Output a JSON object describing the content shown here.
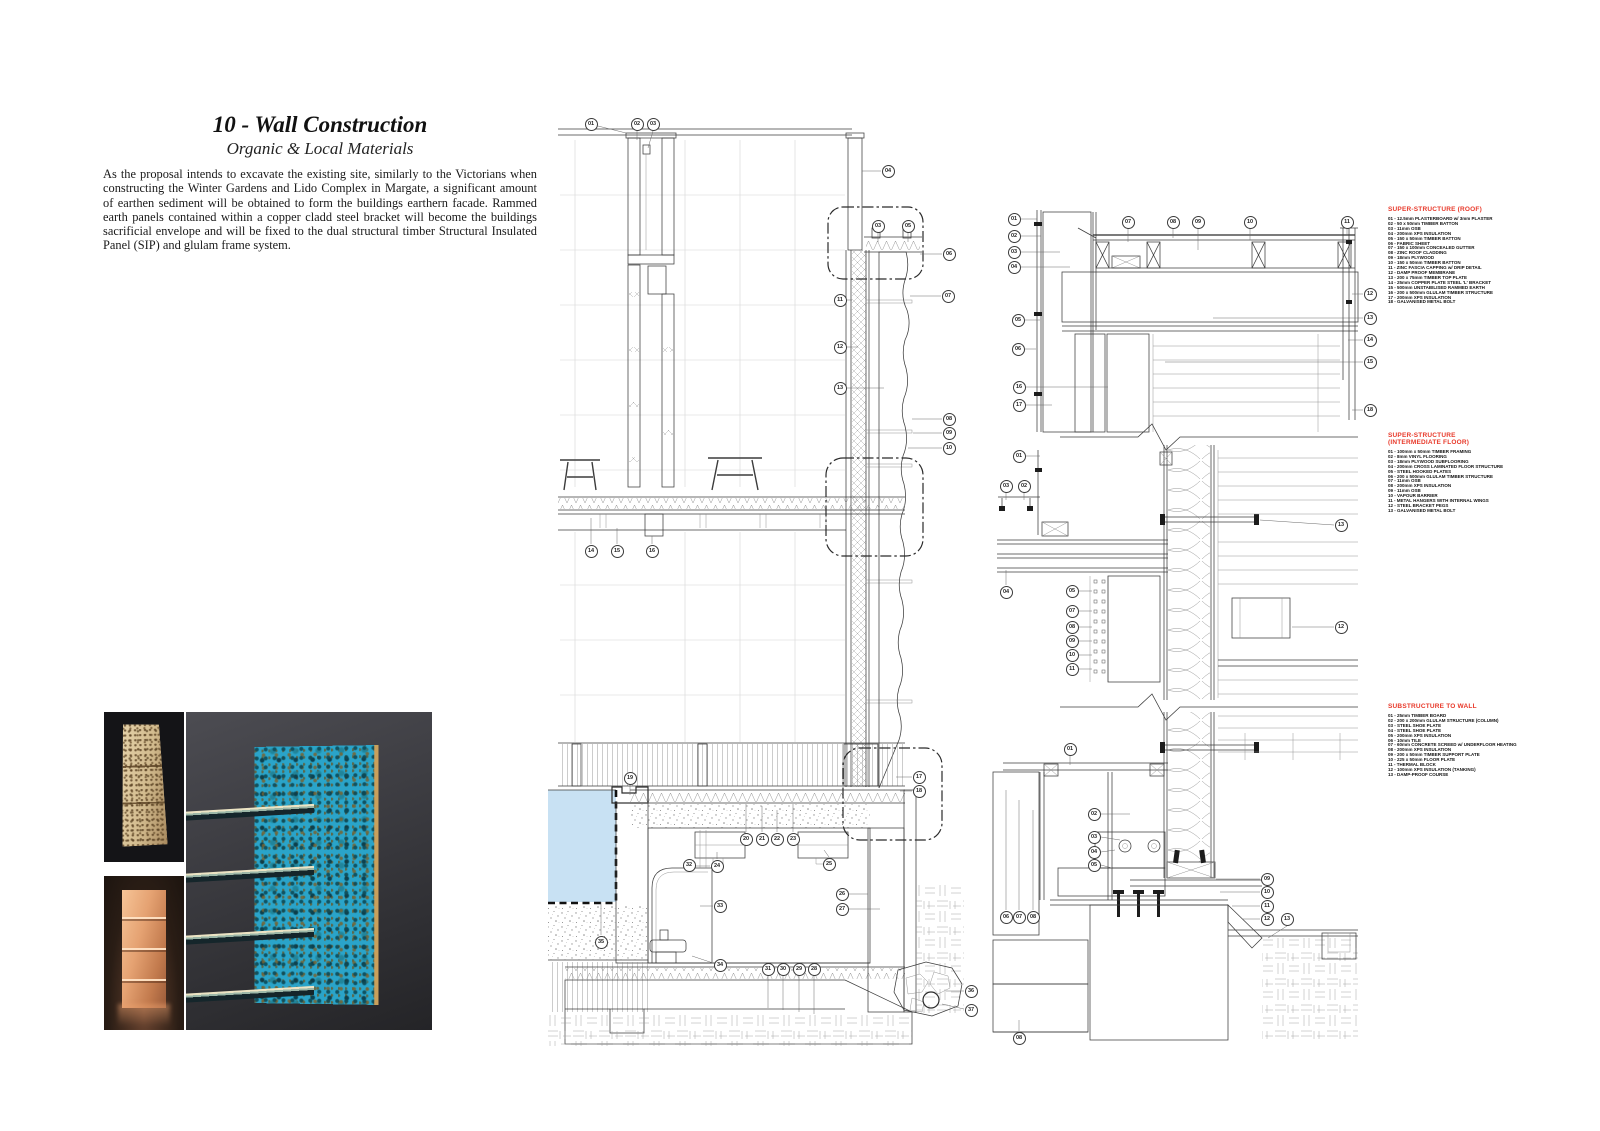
{
  "header": {
    "title": "10 - Wall Construction",
    "subtitle": "Organic & Local Materials",
    "paragraph": "As the proposal intends to excavate the existing site, similarly to the Victorians when constructing the Winter Gardens and Lido Complex in Margate, a significant amount of earthen sediment will be obtained to form the buildings earthern facade. Rammed earth panels contained within a copper cladd steel bracket will become the buildings sacrificial envelope and will be fixed to the dual structural timber Structural Insulated Panel (SIP) and glulam frame system."
  },
  "colors": {
    "legend_heading_red": "#e8392a",
    "pool_water_blue": "#c8e1f3",
    "drawing_line": "#3c3c3c",
    "patina_teal": "#2aa4c9",
    "copper": "#d98e5e",
    "rammed_earth_tan": "#d6c096"
  },
  "photos": [
    {
      "name": "rammed-earth-sample-photo"
    },
    {
      "name": "copper-bracket-sample-photo"
    },
    {
      "name": "verdigris-copper-column-photo"
    }
  ],
  "legends": [
    {
      "x": 1388,
      "y": 206,
      "title_lines": [
        "SUPER-STRUCTURE (ROOF)"
      ],
      "items": [
        "01 - 12.5mm PLASTERBOARD w/ 3mm PLASTER",
        "02 - 50 x 50mm TIMBER BATTON",
        "03 - 11mm OSB",
        "04 - 200mm XPS INSULATION",
        "05 - 150 x 50mm TIMBER BATTON",
        "06 - FABRIC SHEET",
        "07 - 150 x 100mm CONCEALED GUTTER",
        "08 - ZINC ROOF CLADDING",
        "09 - 18mm PLYWOOD",
        "10 - 150 x 50mm TIMBER BATTON",
        "11 - ZINC FASCIA CAPPING w/ DRIP DETAIL",
        "12 - DAMP PROOF MEMBRANE",
        "13 - 200 x 75mm TIMBER TOP PLATE",
        "14 - 25mm COPPER PLATE STEEL 'L' BRACKET",
        "15 - 500mm UNSTABILISED RAMMED EARTH",
        "16 - 200 x 500mm GLULAM TIMBER STRUCTURE",
        "17 - 200mm XPS INSULATION",
        "18 - GALVANISED METAL BOLT"
      ]
    },
    {
      "x": 1388,
      "y": 432,
      "title_lines": [
        "SUPER-STRUCTURE",
        "(INTERMEDIATE FLOOR)"
      ],
      "items": [
        "01 - 100mm x 50mm TIMBER FRAMING",
        "02 - 8mm VINYL FLOORING",
        "03 - 18mm PLYWOOD SUBFLOORING",
        "04 - 200mm CROSS LAMINATED FLOOR STRUCTURE",
        "05 - STEEL HOOKED PLATES",
        "06 - 200 x 500mm GLULAM TIMBER STRUCTURE",
        "07 - 11mm OSB",
        "08 - 200mm XPS INSULATION",
        "09 - 11mm OSB",
        "10 - VAPOUR BARRIER",
        "11 - METAL HANGERS WITH INTERNAL WINGS",
        "12 - STEEL BRACKET PEGS",
        "13 - GALVANISED METAL BOLT"
      ]
    },
    {
      "x": 1388,
      "y": 703,
      "title_lines": [
        "SUBSTRUCTURE TO WALL"
      ],
      "items": [
        "01 - 25mm TIMBER BOARD",
        "02 - 200 x 200mm GLULAM STRUCTURE (COLUMN)",
        "03 - STEEL SHOE PLATE",
        "04 - STEEL SHOE PLATE",
        "05 - 200mm XPS INSULATION",
        "06 - 10mm TILE",
        "07 - 60mm CONCRETE SCREED w/ UNDERFLOOR HEATING",
        "08 - 200mm XPS INSULATION",
        "09 - 200 x 50mm TIMBER SUPPORT PLATE",
        "10 - 225 x 50mm FLOOR PLATE",
        "11 - THERMAL BLOCK",
        "12 - 100mm XPS INSULATION (TANKING)",
        "13 - DAMP-PROOF COURSE"
      ]
    }
  ],
  "callouts": [
    {
      "g": "main-section",
      "n": "01",
      "x": 591,
      "y": 124
    },
    {
      "g": "main-section",
      "n": "02",
      "x": 637,
      "y": 124
    },
    {
      "g": "main-section",
      "n": "03",
      "x": 653,
      "y": 124
    },
    {
      "g": "main-section",
      "n": "04",
      "x": 888,
      "y": 171
    },
    {
      "g": "main-section",
      "n": "03",
      "x": 878,
      "y": 226
    },
    {
      "g": "main-section",
      "n": "05",
      "x": 908,
      "y": 226
    },
    {
      "g": "main-section",
      "n": "06",
      "x": 949,
      "y": 254
    },
    {
      "g": "main-section",
      "n": "07",
      "x": 948,
      "y": 296
    },
    {
      "g": "main-section",
      "n": "11",
      "x": 840,
      "y": 300
    },
    {
      "g": "main-section",
      "n": "12",
      "x": 840,
      "y": 347
    },
    {
      "g": "main-section",
      "n": "13",
      "x": 840,
      "y": 388
    },
    {
      "g": "main-section",
      "n": "08",
      "x": 949,
      "y": 419
    },
    {
      "g": "main-section",
      "n": "09",
      "x": 949,
      "y": 433
    },
    {
      "g": "main-section",
      "n": "10",
      "x": 949,
      "y": 448
    },
    {
      "g": "main-section",
      "n": "14",
      "x": 591,
      "y": 551
    },
    {
      "g": "main-section",
      "n": "15",
      "x": 617,
      "y": 551
    },
    {
      "g": "main-section",
      "n": "16",
      "x": 652,
      "y": 551
    },
    {
      "g": "main-section",
      "n": "19",
      "x": 630,
      "y": 778
    },
    {
      "g": "main-section",
      "n": "17",
      "x": 919,
      "y": 777
    },
    {
      "g": "main-section",
      "n": "18",
      "x": 919,
      "y": 791
    },
    {
      "g": "main-section",
      "n": "20",
      "x": 746,
      "y": 839
    },
    {
      "g": "main-section",
      "n": "21",
      "x": 762,
      "y": 839
    },
    {
      "g": "main-section",
      "n": "22",
      "x": 777,
      "y": 839
    },
    {
      "g": "main-section",
      "n": "23",
      "x": 793,
      "y": 839
    },
    {
      "g": "main-section",
      "n": "32",
      "x": 689,
      "y": 865
    },
    {
      "g": "main-section",
      "n": "24",
      "x": 717,
      "y": 866
    },
    {
      "g": "main-section",
      "n": "25",
      "x": 829,
      "y": 864
    },
    {
      "g": "main-section",
      "n": "26",
      "x": 842,
      "y": 894
    },
    {
      "g": "main-section",
      "n": "27",
      "x": 842,
      "y": 909
    },
    {
      "g": "main-section",
      "n": "33",
      "x": 720,
      "y": 906
    },
    {
      "g": "main-section",
      "n": "35",
      "x": 601,
      "y": 942
    },
    {
      "g": "main-section",
      "n": "34",
      "x": 720,
      "y": 965
    },
    {
      "g": "main-section",
      "n": "31",
      "x": 768,
      "y": 969
    },
    {
      "g": "main-section",
      "n": "30",
      "x": 783,
      "y": 969
    },
    {
      "g": "main-section",
      "n": "29",
      "x": 799,
      "y": 969
    },
    {
      "g": "main-section",
      "n": "28",
      "x": 814,
      "y": 969
    },
    {
      "g": "main-section",
      "n": "36",
      "x": 971,
      "y": 991
    },
    {
      "g": "main-section",
      "n": "37",
      "x": 971,
      "y": 1010
    },
    {
      "g": "roof-detail",
      "n": "01",
      "x": 1014,
      "y": 219
    },
    {
      "g": "roof-detail",
      "n": "02",
      "x": 1014,
      "y": 236
    },
    {
      "g": "roof-detail",
      "n": "03",
      "x": 1014,
      "y": 252
    },
    {
      "g": "roof-detail",
      "n": "04",
      "x": 1014,
      "y": 267
    },
    {
      "g": "roof-detail",
      "n": "05",
      "x": 1018,
      "y": 320
    },
    {
      "g": "roof-detail",
      "n": "06",
      "x": 1018,
      "y": 349
    },
    {
      "g": "roof-detail",
      "n": "16",
      "x": 1019,
      "y": 387
    },
    {
      "g": "roof-detail",
      "n": "17",
      "x": 1019,
      "y": 405
    },
    {
      "g": "roof-detail",
      "n": "07",
      "x": 1128,
      "y": 222
    },
    {
      "g": "roof-detail",
      "n": "08",
      "x": 1173,
      "y": 222
    },
    {
      "g": "roof-detail",
      "n": "09",
      "x": 1198,
      "y": 222
    },
    {
      "g": "roof-detail",
      "n": "10",
      "x": 1250,
      "y": 222
    },
    {
      "g": "roof-detail",
      "n": "11",
      "x": 1347,
      "y": 222
    },
    {
      "g": "roof-detail",
      "n": "12",
      "x": 1370,
      "y": 294
    },
    {
      "g": "roof-detail",
      "n": "13",
      "x": 1370,
      "y": 318
    },
    {
      "g": "roof-detail",
      "n": "14",
      "x": 1370,
      "y": 340
    },
    {
      "g": "roof-detail",
      "n": "15",
      "x": 1370,
      "y": 362
    },
    {
      "g": "roof-detail",
      "n": "18",
      "x": 1370,
      "y": 410
    },
    {
      "g": "floor-detail",
      "n": "01",
      "x": 1019,
      "y": 456
    },
    {
      "g": "floor-detail",
      "n": "03",
      "x": 1006,
      "y": 486
    },
    {
      "g": "floor-detail",
      "n": "02",
      "x": 1024,
      "y": 486
    },
    {
      "g": "floor-detail",
      "n": "04",
      "x": 1006,
      "y": 592
    },
    {
      "g": "floor-detail",
      "n": "05",
      "x": 1072,
      "y": 591
    },
    {
      "g": "floor-detail",
      "n": "07",
      "x": 1072,
      "y": 611
    },
    {
      "g": "floor-detail",
      "n": "08",
      "x": 1072,
      "y": 627
    },
    {
      "g": "floor-detail",
      "n": "09",
      "x": 1072,
      "y": 641
    },
    {
      "g": "floor-detail",
      "n": "10",
      "x": 1072,
      "y": 655
    },
    {
      "g": "floor-detail",
      "n": "11",
      "x": 1072,
      "y": 669
    },
    {
      "g": "floor-detail",
      "n": "13",
      "x": 1341,
      "y": 525
    },
    {
      "g": "floor-detail",
      "n": "12",
      "x": 1341,
      "y": 627
    },
    {
      "g": "substructure-detail",
      "n": "01",
      "x": 1070,
      "y": 749
    },
    {
      "g": "substructure-detail",
      "n": "02",
      "x": 1094,
      "y": 814
    },
    {
      "g": "substructure-detail",
      "n": "03",
      "x": 1094,
      "y": 837
    },
    {
      "g": "substructure-detail",
      "n": "04",
      "x": 1094,
      "y": 852
    },
    {
      "g": "substructure-detail",
      "n": "05",
      "x": 1094,
      "y": 865
    },
    {
      "g": "substructure-detail",
      "n": "06",
      "x": 1006,
      "y": 917
    },
    {
      "g": "substructure-detail",
      "n": "07",
      "x": 1019,
      "y": 917
    },
    {
      "g": "substructure-detail",
      "n": "08",
      "x": 1033,
      "y": 917
    },
    {
      "g": "substructure-detail",
      "n": "09",
      "x": 1267,
      "y": 879
    },
    {
      "g": "substructure-detail",
      "n": "10",
      "x": 1267,
      "y": 892
    },
    {
      "g": "substructure-detail",
      "n": "11",
      "x": 1267,
      "y": 906
    },
    {
      "g": "substructure-detail",
      "n": "12",
      "x": 1267,
      "y": 919
    },
    {
      "g": "substructure-detail",
      "n": "13",
      "x": 1287,
      "y": 919
    },
    {
      "g": "substructure-detail",
      "n": "08",
      "x": 1019,
      "y": 1038
    }
  ]
}
